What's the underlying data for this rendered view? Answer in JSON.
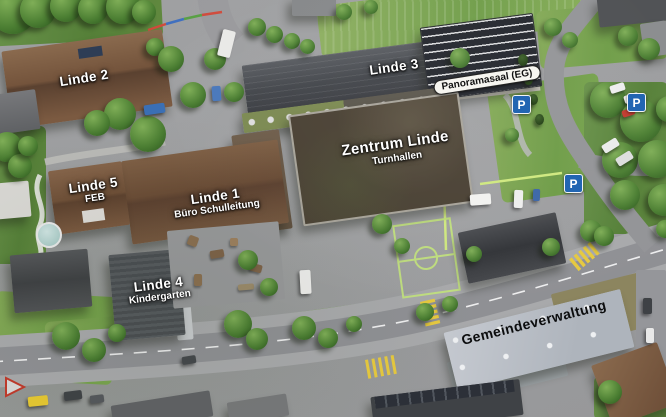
{
  "map": {
    "labels": {
      "linde2": {
        "title": "Linde 2"
      },
      "linde3": {
        "title": "Linde 3"
      },
      "panoramasaal": {
        "title": "Panoramasaal (EG)"
      },
      "zentrum_linde": {
        "title": "Zentrum Linde",
        "subtitle": "Turnhallen"
      },
      "linde5": {
        "title": "Linde 5",
        "subtitle": "FEB"
      },
      "linde1": {
        "title": "Linde 1",
        "subtitle": "Büro Schulleitung"
      },
      "linde4": {
        "title": "Linde 4",
        "subtitle": "Kindergarten"
      },
      "gemeindeverwaltung": {
        "title": "Gemeindeverwaltung"
      }
    },
    "icons": {
      "parking": {
        "symbol": "P",
        "count": 3,
        "color": "#2265b2"
      }
    },
    "colors": {
      "label_light": "#ffffff",
      "label_dark": "#111111",
      "badge_background": "#f6f5f0",
      "crosswalk_yellow": "#e6c93f"
    }
  }
}
